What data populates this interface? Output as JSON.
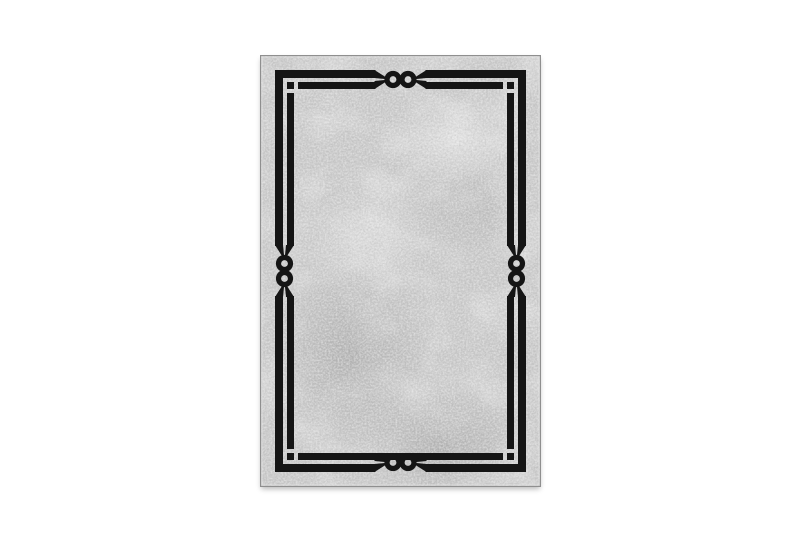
{
  "page": {
    "background": "#ffffff"
  },
  "rug": {
    "subject": "Grey distressed rectangular area rug with a black double-line border frame, detached square dots in the corners and twin-ring chain knot motifs at the middle of each side",
    "colors": {
      "field_base": "#c6c6c6",
      "frame_black": "#151515",
      "edge_gray": "#8f8f8f",
      "edge_highlight": "#e3e3e3",
      "texture_dark": "#8c8c8c",
      "texture_light": "#f2f2f2"
    },
    "motif_counts": {
      "corner_dots": 4,
      "side_knots": 4
    }
  }
}
